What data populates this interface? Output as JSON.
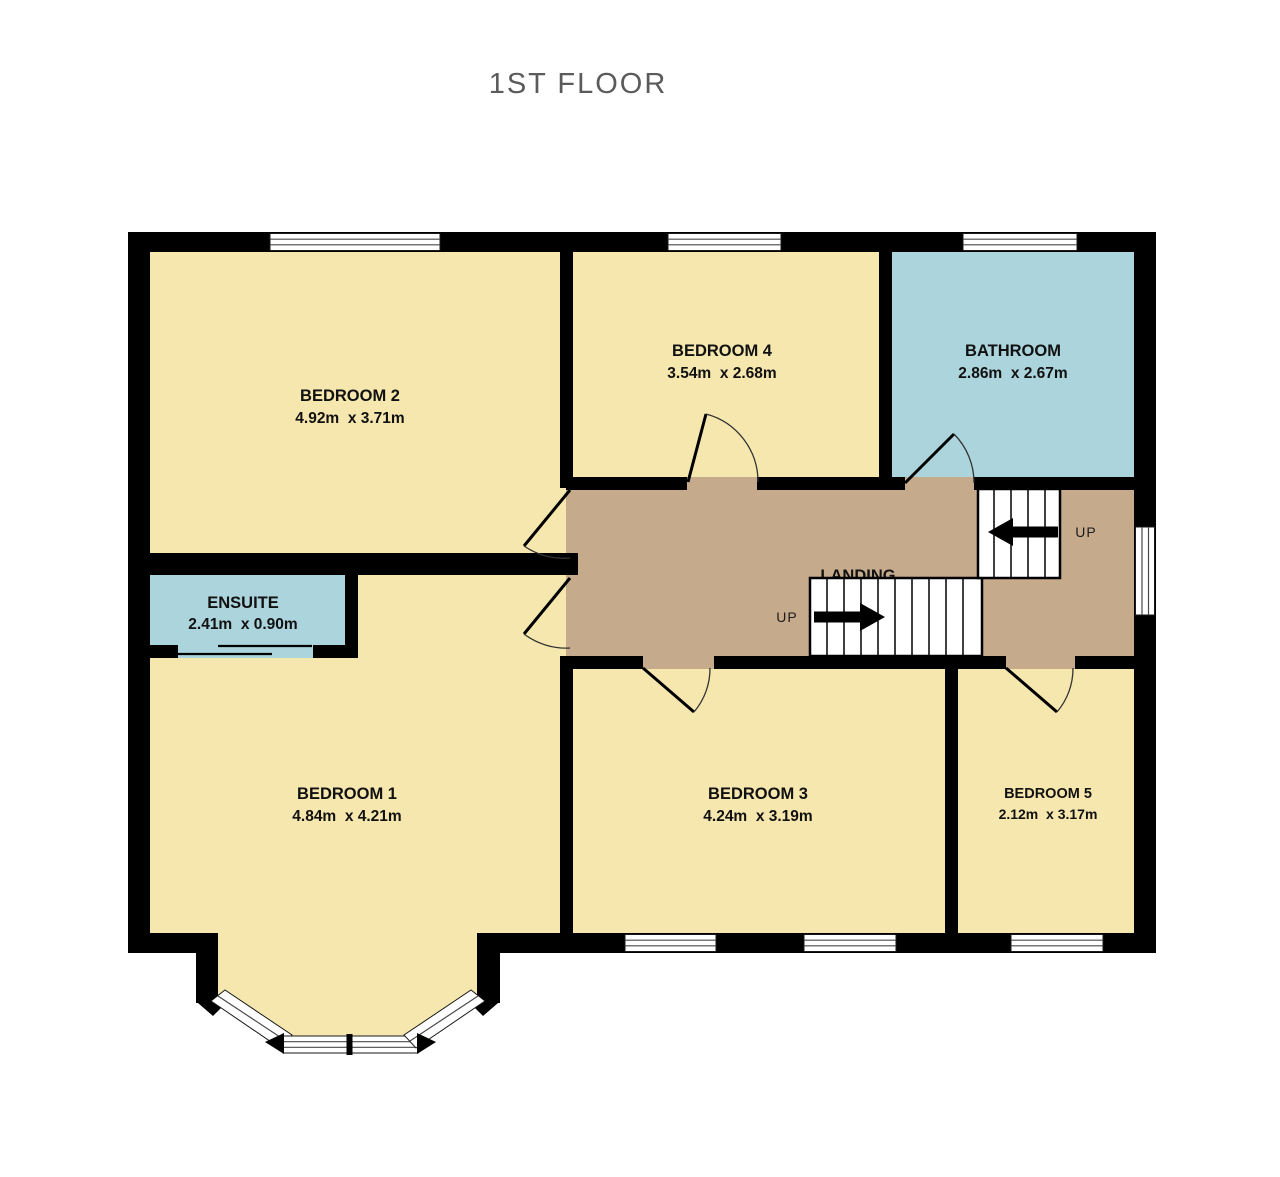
{
  "title": "1ST FLOOR",
  "colors": {
    "room": "#F6E7AF",
    "wet_room": "#ACD4DC",
    "landing": "#C5AA8B",
    "wall": "#000000",
    "title_text": "#5B5B5B",
    "label_text": "#111111"
  },
  "floor_plan": {
    "rooms": {
      "bedroom1": {
        "label": "BEDROOM 1",
        "dimensions": "4.84m  x 4.21m"
      },
      "bedroom2": {
        "label": "BEDROOM 2",
        "dimensions": "4.92m  x 3.71m"
      },
      "bedroom3": {
        "label": "BEDROOM 3",
        "dimensions": "4.24m  x 3.19m"
      },
      "bedroom4": {
        "label": "BEDROOM 4",
        "dimensions": "3.54m  x 2.68m"
      },
      "bedroom5": {
        "label": "BEDROOM 5",
        "dimensions": "2.12m  x 3.17m"
      },
      "bathroom": {
        "label": "BATHROOM",
        "dimensions": "2.86m  x 2.67m"
      },
      "ensuite": {
        "label": "ENSUITE",
        "dimensions": "2.41m  x 0.90m"
      },
      "landing": {
        "label": "LANDING"
      }
    },
    "stairs": {
      "lower_flight_direction": "UP",
      "upper_flight_direction": "UP"
    }
  }
}
